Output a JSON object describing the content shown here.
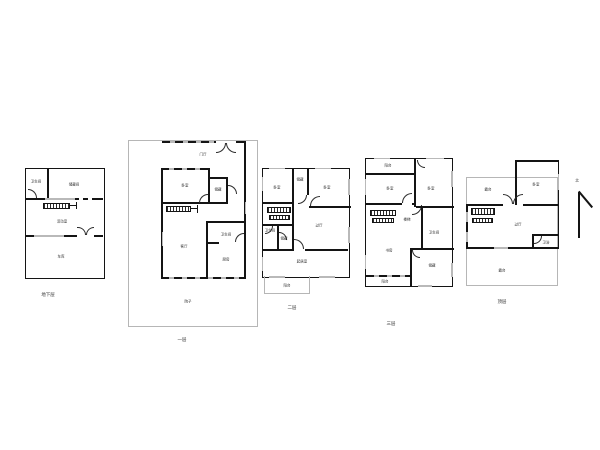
{
  "drawing": {
    "type": "floor-plan-sheet",
    "colors": {
      "wall": "#141414",
      "boundary": "#b6b6b6",
      "window": "#b9b9b9",
      "background": "#ffffff"
    },
    "north": {
      "label": "北"
    },
    "plans": [
      {
        "caption": "地下层",
        "rooms": [
          "卫生间",
          "储藏间",
          "活动室",
          "车库"
        ]
      },
      {
        "caption": "一层",
        "rooms": [
          "门厅",
          "卧室",
          "储藏",
          "客厅",
          "卫生间",
          "厨房",
          "院子"
        ]
      },
      {
        "caption": "二层",
        "rooms": [
          "卧室",
          "储藏",
          "卧室",
          "卫生间",
          "储藏",
          "过厅",
          "起居室",
          "阳台"
        ]
      },
      {
        "caption": "三层",
        "rooms": [
          "阳台",
          "卧室",
          "卧室",
          "楼梯",
          "书房",
          "卫生间",
          "储藏",
          "阳台"
        ]
      },
      {
        "caption": "顶层",
        "rooms": [
          "露台",
          "卧室",
          "过厅",
          "卫浴",
          "露台"
        ]
      }
    ]
  }
}
